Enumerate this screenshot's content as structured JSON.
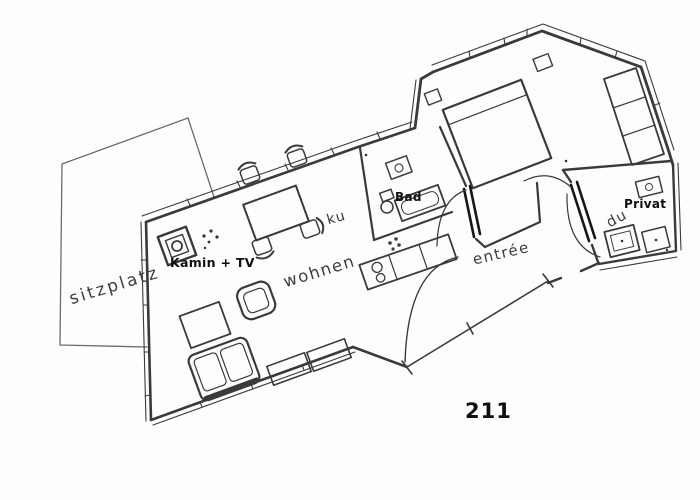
{
  "plan": {
    "room_number": "211",
    "labels": {
      "terrace": "sitzplatz",
      "fireplace_tv": "Kamin + TV",
      "kitchen": "ku",
      "bathroom": "Bad",
      "living_room": "wohnen",
      "entry": "entrée",
      "shower": "du",
      "private_room": "Privat"
    },
    "colors": {
      "paper": "#fdfdfc",
      "ink": "#3d3d3d",
      "ink_bold": "#111111",
      "wall": "#3a3a3a",
      "door": "#161616"
    }
  }
}
